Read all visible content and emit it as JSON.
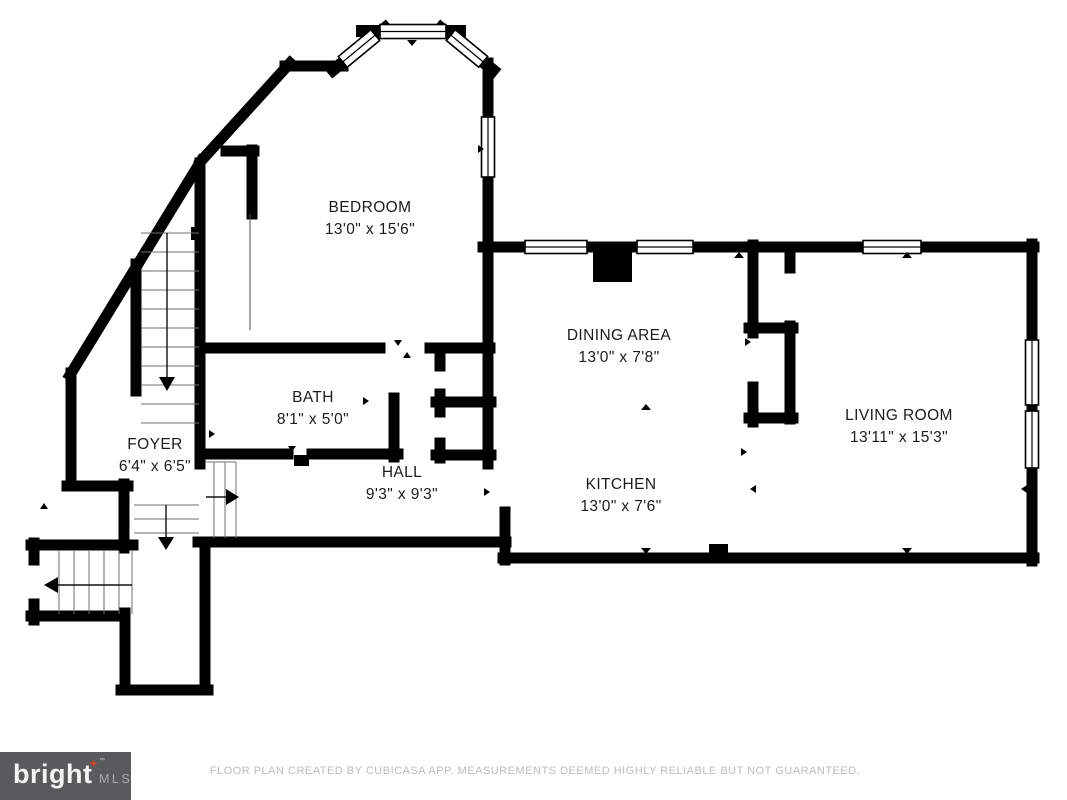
{
  "rooms": [
    {
      "name": "BEDROOM",
      "dims": "13'0\" x 15'6\""
    },
    {
      "name": "BATH",
      "dims": "8'1\" x 5'0\""
    },
    {
      "name": "FOYER",
      "dims": "6'4\" x 6'5\""
    },
    {
      "name": "HALL",
      "dims": "9'3\" x 9'3\""
    },
    {
      "name": "DINING AREA",
      "dims": "13'0\" x 7'8\""
    },
    {
      "name": "KITCHEN",
      "dims": "13'0\" x 7'6\""
    },
    {
      "name": "LIVING ROOM",
      "dims": "13'11\" x 15'3\""
    }
  ],
  "footer": {
    "disclaimer": "FLOOR PLAN CREATED BY CUBICASA APP. MEASUREMENTS DEEMED HIGHLY RELIABLE BUT NOT GUARANTEED."
  },
  "logo": {
    "brand": "bright",
    "mls": "MLS",
    "tm": "™",
    "star": "✦"
  },
  "colors": {
    "wall": "#000000",
    "background": "#ffffff",
    "logo_bg": "#595a5c",
    "logo_star": "#c1472b",
    "logo_mls": "#a8aaad",
    "disclaimer": "#bcbcbc"
  }
}
